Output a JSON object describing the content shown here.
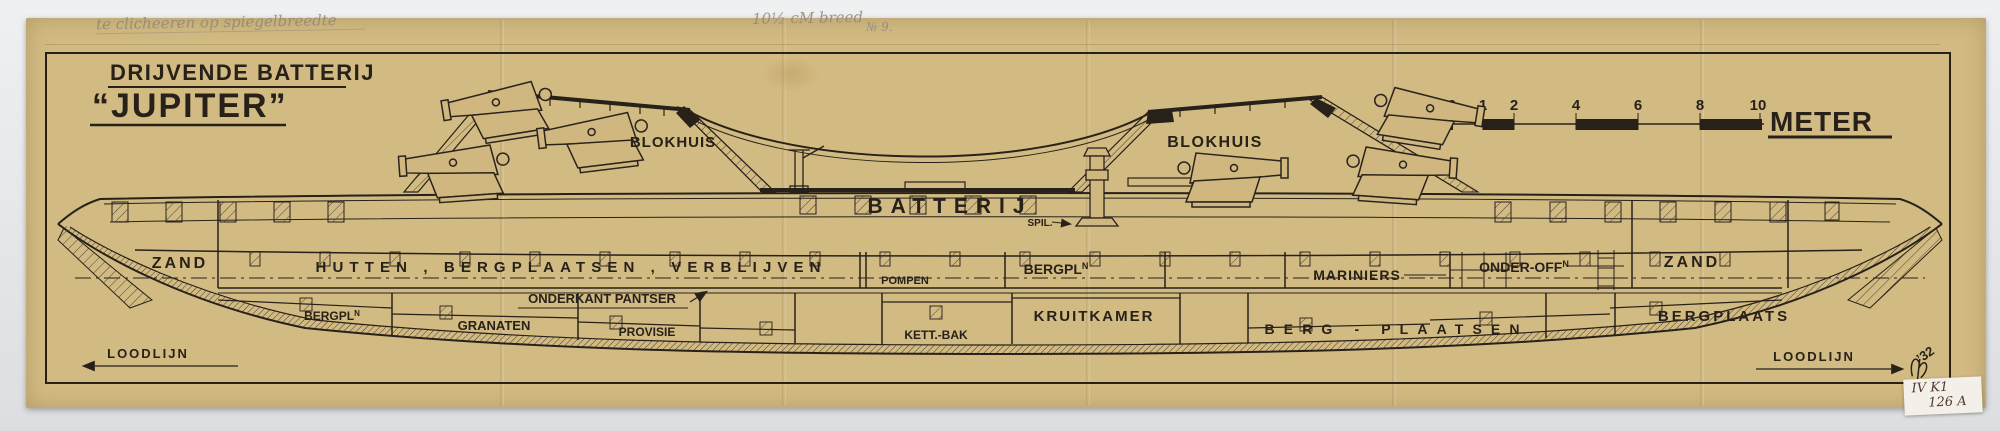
{
  "document": {
    "title_line1": "DRIJVENDE BATTERIJ",
    "title_line2": "“JUPITER”"
  },
  "pencil_annotations": {
    "top_left": "te clicheeren op spiegelbreedte",
    "top_center": "10½ cM breed",
    "top_right": "№ 9.",
    "year_signature": "’32"
  },
  "scale_bar": {
    "ticks": [
      "0",
      "1",
      "2",
      "4",
      "6",
      "8",
      "10"
    ],
    "unit": "METER"
  },
  "compartment_labels": {
    "blokhuis_left": "BLOKHUIS",
    "blokhuis_right": "BLOKHUIS",
    "batterij": "BATTERIJ",
    "spil": "SPIL.",
    "zand_left": "ZAND",
    "hutten_row": "HUTTEN , BERGPLAATSEN , VERBLIJVEN",
    "pompen": "POMPEN",
    "bergpl_upper_base": "BERGPL",
    "bergpl_upper_sup": "N",
    "mariniers": "MARINIERS",
    "onder_off_base": "ONDER-OFF",
    "onder_off_sup": "N",
    "zand_right": "ZAND",
    "onderkant_pantser": "ONDERKANT PANTSER",
    "bergpl_lower_base": "BERGPL",
    "bergpl_lower_sup": "N",
    "granaten": "GRANATEN",
    "provisie": "PROVISIE",
    "kett_bak": "KETT.-BAK",
    "kruitkamer": "KRUITKAMER",
    "berg_plaatsen": "BERG - PLAATSEN",
    "bergplaats": "BERGPLAATS",
    "loodlijn_left": "LOODLIJN",
    "loodlijn_right": "LOODLIJN"
  },
  "archive_sticker": {
    "line1": "IV K1",
    "line2": "126 A"
  },
  "colors": {
    "paper": "#d2ba83",
    "ink": "#272119",
    "backdrop": "#e9eaec",
    "pencil": "#8f8878",
    "sticker": "#f3f0e9"
  }
}
